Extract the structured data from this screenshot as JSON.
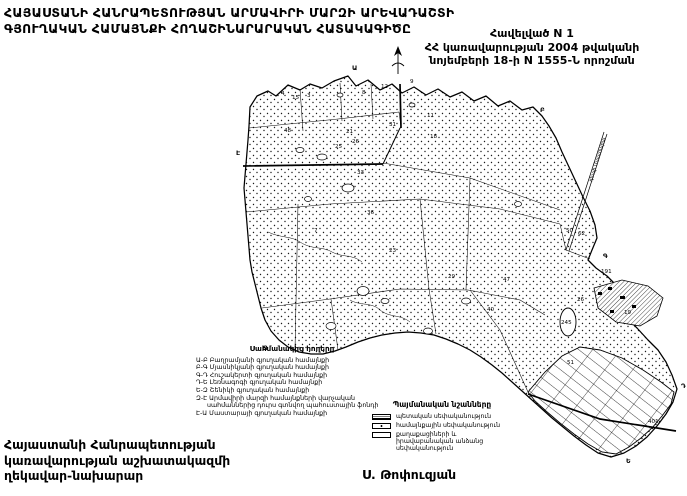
{
  "header": {
    "title_line1": "ՀԱՅԱՍՏԱՆԻ ՀԱՆՐԱՊԵՏՈՒԹՅԱՆ ԱՐՄԱՎԻՐԻ ՄԱՐԶԻ ԱՐԵՎԱԴԱՇՏԻ",
    "title_line2": "ԳՅՈՒՂԱԿԱՆ ՀԱՄԱՅՆՔԻ ՀՈՂԱՇԻՆԱՐԱՐԱԿԱՆ ՀԱՏԱԿԱԳԻԾԸ",
    "appendix_line1": "Հավելված N 1",
    "appendix_line2": "ՀՀ կառավարության 2004 թվականի",
    "appendix_line3": "նոյեմբերի 18-ի N 1555-Ն որոշման"
  },
  "legend_border": {
    "title": "Սահմանակից հողերը",
    "items": [
      "Ա-Բ Բաղրամյանի գյուղական համայնքի",
      "Բ-Գ Մյասնիկյանի գյուղական համայնքի",
      "Գ-Դ Հուշակերտի գյուղական համայնքի",
      "Դ-Ե Լեռնագոգի գյուղական համայնքի",
      "Ե-Զ Շենիկի գյուղական համայնքի",
      "Զ-Է Արմավիրի մարզի համայնքների վարչական",
      "սահմաններից դուրս գտնվող պահուստային ֆոնդի",
      "Է-Ա Մաստարայի գյուղական համայնքի"
    ]
  },
  "legend_signs": {
    "title": "Պայմանական նշանները",
    "items": [
      {
        "swatch": "hatch",
        "label": "պետական սեփականություն"
      },
      {
        "swatch": "dot",
        "label": "համայնքային սեփականություն"
      },
      {
        "swatch": "plain",
        "label": "քաղաքացիների և իրավաբանական անձանց սեփականություն"
      }
    ]
  },
  "footer": {
    "org_line1": "Հայաստանի Հանրապետության",
    "org_line2": "կառավարության աշխատակազմի",
    "org_line3": "ղեկավար-նախարար",
    "signer": "Ս. Թոփուզյան"
  },
  "map": {
    "oval_label": "245",
    "road_label": "դեպի Մաստարա",
    "parcels": [
      {
        "n": "4",
        "x": 281,
        "y": 95
      },
      {
        "n": "15",
        "x": 292,
        "y": 99
      },
      {
        "n": "3",
        "x": 307,
        "y": 97
      },
      {
        "n": "8",
        "x": 362,
        "y": 94
      },
      {
        "n": "12",
        "x": 381,
        "y": 88
      },
      {
        "n": "9",
        "x": 410,
        "y": 83
      },
      {
        "n": "48",
        "x": 284,
        "y": 132
      },
      {
        "n": "21",
        "x": 346,
        "y": 133
      },
      {
        "n": "31",
        "x": 389,
        "y": 126
      },
      {
        "n": "26",
        "x": 352,
        "y": 143
      },
      {
        "n": "11",
        "x": 427,
        "y": 117
      },
      {
        "n": "18",
        "x": 430,
        "y": 138
      },
      {
        "n": "25",
        "x": 335,
        "y": 148
      },
      {
        "n": "33",
        "x": 357,
        "y": 174
      },
      {
        "n": "36",
        "x": 367,
        "y": 214
      },
      {
        "n": "7",
        "x": 314,
        "y": 232
      },
      {
        "n": "23",
        "x": 389,
        "y": 252
      },
      {
        "n": "29",
        "x": 448,
        "y": 278
      },
      {
        "n": "47",
        "x": 503,
        "y": 281
      },
      {
        "n": "40",
        "x": 487,
        "y": 311
      },
      {
        "n": "26",
        "x": 577,
        "y": 301
      },
      {
        "n": "191",
        "x": 601,
        "y": 273
      },
      {
        "n": "19",
        "x": 624,
        "y": 314
      },
      {
        "n": "51",
        "x": 567,
        "y": 364
      },
      {
        "n": "50",
        "x": 566,
        "y": 232
      },
      {
        "n": "62",
        "x": 578,
        "y": 235
      },
      {
        "n": "401",
        "x": 648,
        "y": 423
      }
    ],
    "boundary_letters": [
      {
        "l": "Ա",
        "x": 352,
        "y": 70
      },
      {
        "l": "Բ",
        "x": 540,
        "y": 112
      },
      {
        "l": "Գ",
        "x": 603,
        "y": 258
      },
      {
        "l": "Դ",
        "x": 681,
        "y": 388
      },
      {
        "l": "Ե",
        "x": 626,
        "y": 463
      },
      {
        "l": "Զ",
        "x": 263,
        "y": 350
      },
      {
        "l": "Է",
        "x": 236,
        "y": 155
      }
    ]
  },
  "colors": {
    "ink": "#000000",
    "paper": "#ffffff"
  }
}
